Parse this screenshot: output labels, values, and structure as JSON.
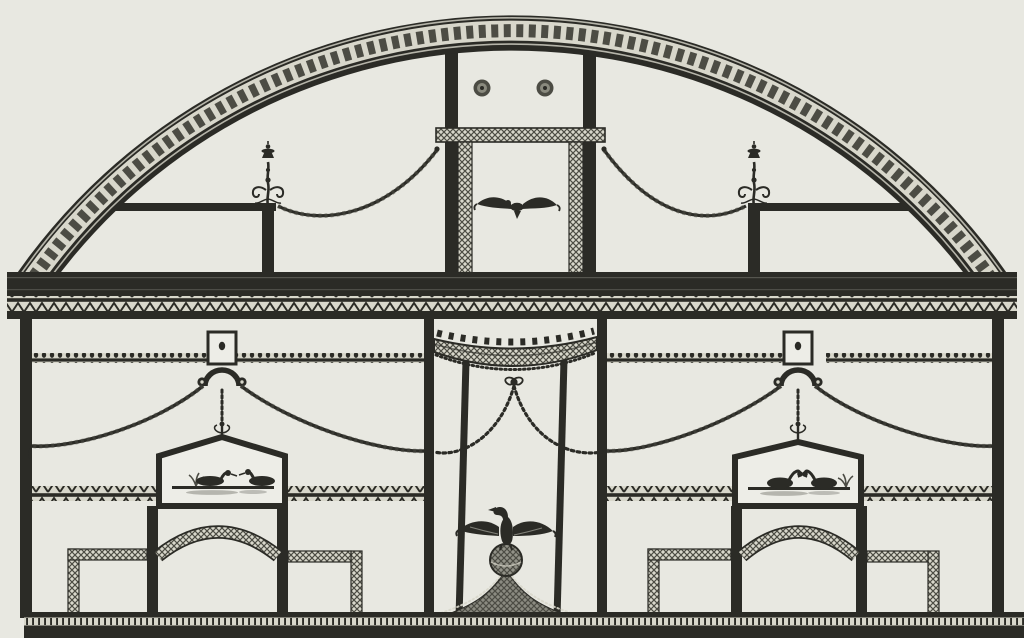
{
  "artwork": {
    "description": "Black-ink engraved elevation of a decorated wall in the Pompeian style: a semicircular lunette bordered by a dark running-scroll arch contains two candelabra, garland swags, a pair of rosettes and a framed flying bird; below a zigzag entablature, the wall has two bays with pendant plaques, scrolled brackets and rope swags over pedimented panels of waterfowl, flanking a central canopied aedicula with hanging chains and an eagle standing on a globe above a curved hatched pediment; arched dado panels and a dark plinth run along the bottom.",
    "medium": "engraving, dark ink on cream paper"
  },
  "lunette": {
    "rosette_count": 2,
    "motifs": [
      "arch-scroll-border",
      "left-candelabrum",
      "right-candelabrum",
      "garland-swag-left",
      "garland-swag-right",
      "rosette-pair",
      "guilloche-band",
      "flying-bird-panel"
    ]
  },
  "entablature": {
    "motifs": [
      "dark-fascia",
      "zigzag-band",
      "dark-fillet"
    ]
  },
  "wall": {
    "left_bay": {
      "panel_subject": "two ducks swimming on water with reeds",
      "motifs": [
        "pendant-plaque",
        "arched-hood",
        "scroll-brackets",
        "beaded-drop",
        "rope-swag-to-wall",
        "rope-swag-to-center",
        "bead-band",
        "zigzag-band",
        "pedimented-waterfowl-panel",
        "arched-dado-panel"
      ]
    },
    "center": {
      "motifs": [
        "scalloped-canopy",
        "hanging-chain-swags",
        "tied-knot",
        "eagle-on-globe",
        "curved-hatched-pediment"
      ]
    },
    "right_bay": {
      "panel_subject": "two swans facing each other on water with reeds",
      "motifs": [
        "pendant-plaque",
        "arched-hood",
        "scroll-brackets",
        "beaded-drop",
        "rope-swag-to-center",
        "rope-swag-to-wall",
        "bead-band",
        "zigzag-band",
        "pedimented-waterfowl-panel",
        "arched-dado-panel"
      ]
    }
  },
  "plinth": {
    "motifs": [
      "base-line",
      "bead-course",
      "dark-band"
    ]
  },
  "colors": {
    "paper": "#e8e8e1",
    "paper2": "#edede7",
    "ink": "#2b2b26",
    "soft": "#4c4c44",
    "mid": "#8a8a7e",
    "light": "#d8d7cb"
  }
}
